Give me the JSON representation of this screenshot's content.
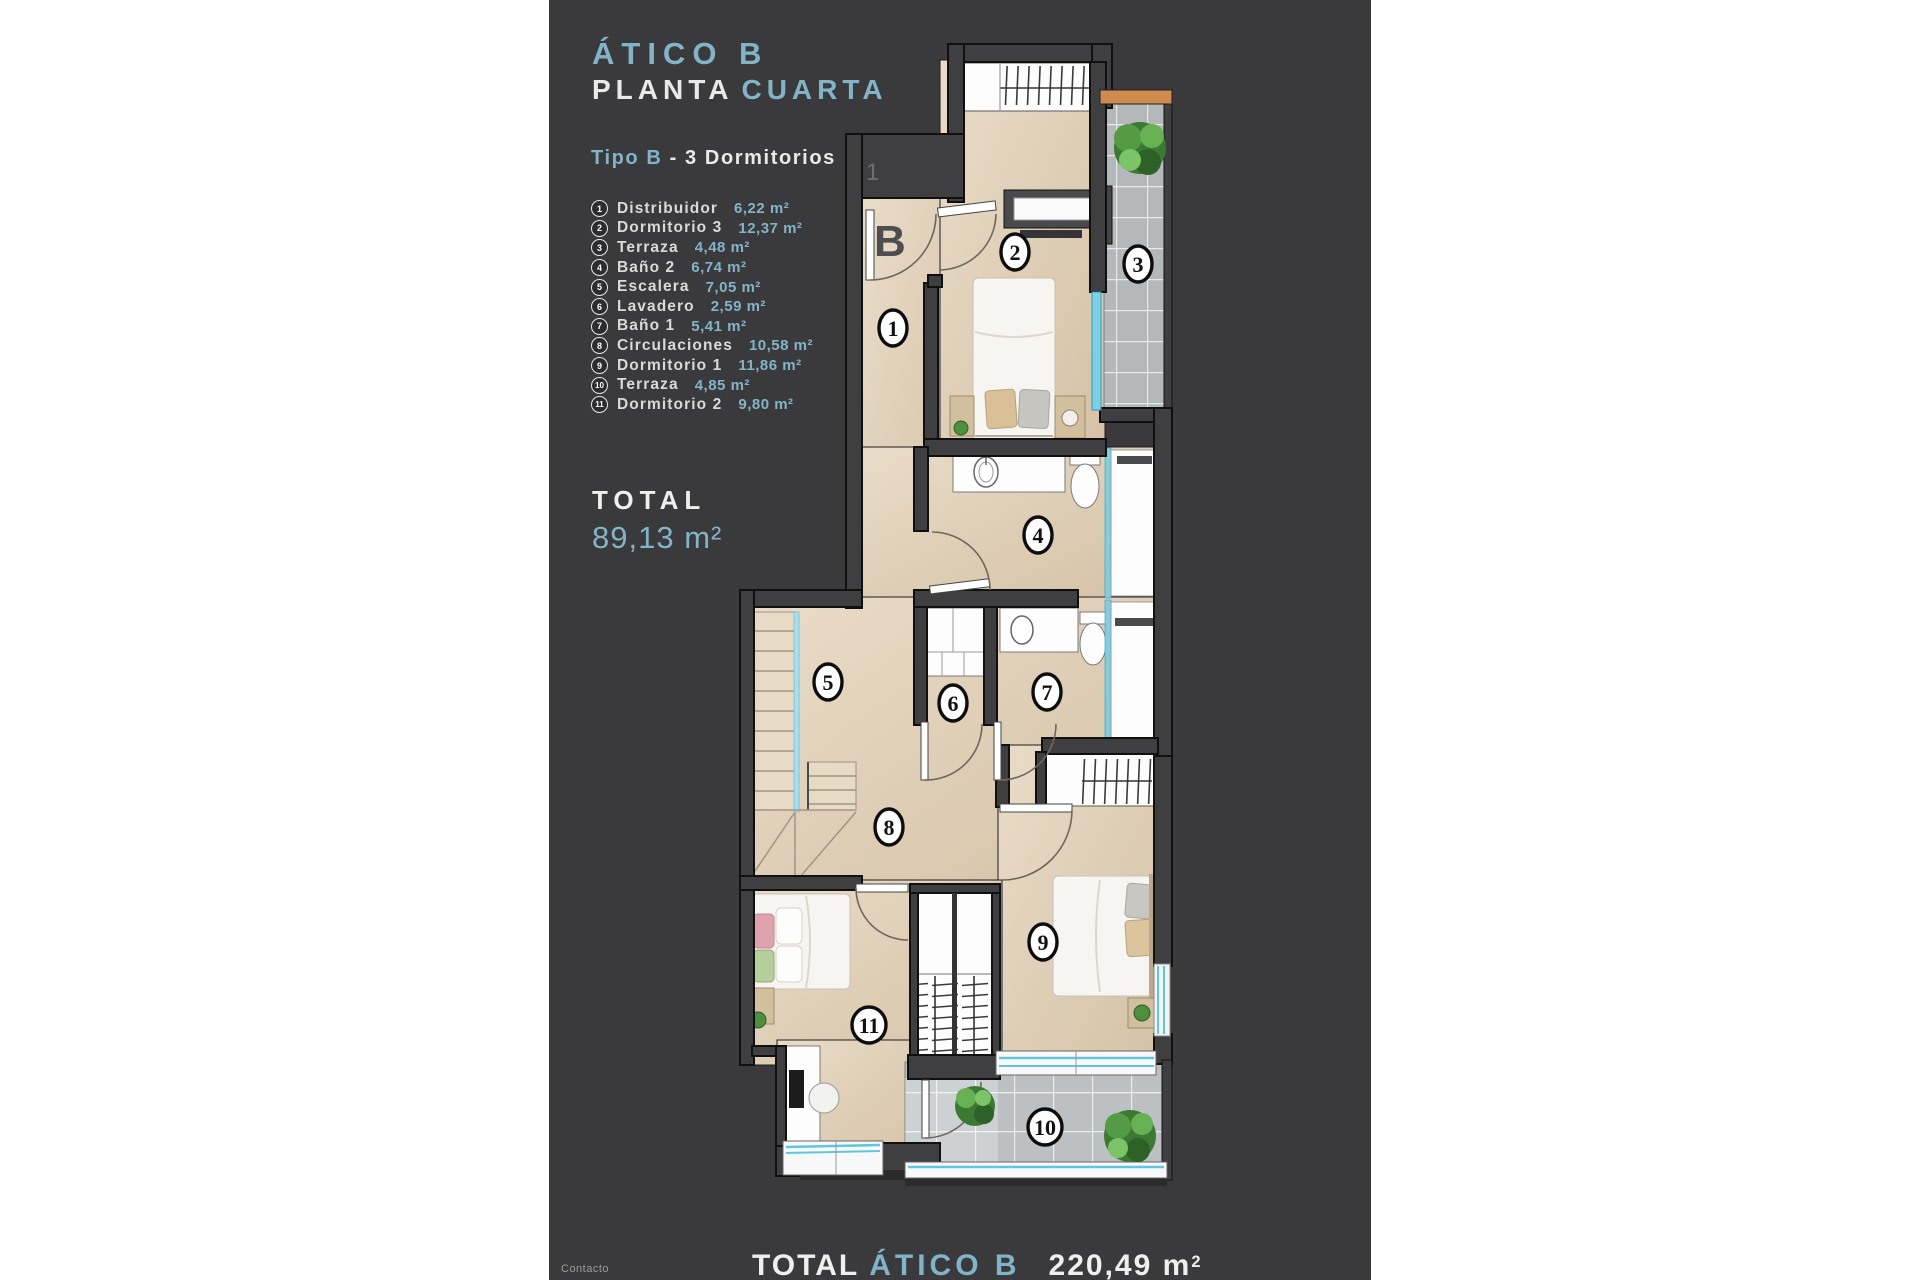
{
  "colors": {
    "accent": "#82b4c8",
    "panel_bg": "#3a3a3c",
    "page_bg": "#ffffff",
    "floor": "#e2d2ba",
    "wall": "#3f3f42",
    "tile": "#b6b9bb",
    "window_cyan": "#7ecfe4",
    "ledge_orange": "#cf8a4d"
  },
  "header": {
    "title": "ÁTICO B",
    "floor_white": "PLANTA",
    "floor_accent": "CUARTA",
    "type_accent": "Tipo B",
    "type_rest": "- 3 Dormitorios"
  },
  "legend": {
    "items": [
      {
        "num": "1",
        "label": "Distribuidor",
        "area": "6,22 m²"
      },
      {
        "num": "2",
        "label": "Dormitorio 3",
        "area": "12,37 m²"
      },
      {
        "num": "3",
        "label": "Terraza",
        "area": "4,48 m²"
      },
      {
        "num": "4",
        "label": "Baño 2",
        "area": "6,74 m²"
      },
      {
        "num": "5",
        "label": "Escalera",
        "area": "7,05 m²"
      },
      {
        "num": "6",
        "label": "Lavadero",
        "area": "2,59 m²"
      },
      {
        "num": "7",
        "label": "Baño 1",
        "area": "5,41 m²"
      },
      {
        "num": "8",
        "label": "Circulaciones",
        "area": "10,58 m²"
      },
      {
        "num": "9",
        "label": "Dormitorio 1",
        "area": "11,86 m²"
      },
      {
        "num": "10",
        "label": "Terraza",
        "area": "4,85 m²"
      },
      {
        "num": "11",
        "label": "Dormitorio 2",
        "area": "9,80 m²"
      }
    ]
  },
  "total": {
    "label": "TOTAL",
    "value": "89,13 m²"
  },
  "plan": {
    "entrance_label": "B",
    "faint_mark": "1",
    "rooms": [
      {
        "num": "1",
        "x": 893,
        "y": 328
      },
      {
        "num": "2",
        "x": 1015,
        "y": 252
      },
      {
        "num": "3",
        "x": 1138,
        "y": 264
      },
      {
        "num": "4",
        "x": 1038,
        "y": 535
      },
      {
        "num": "5",
        "x": 828,
        "y": 682
      },
      {
        "num": "6",
        "x": 953,
        "y": 703
      },
      {
        "num": "7",
        "x": 1047,
        "y": 692
      },
      {
        "num": "8",
        "x": 889,
        "y": 827
      },
      {
        "num": "9",
        "x": 1043,
        "y": 942
      },
      {
        "num": "10",
        "x": 1045,
        "y": 1127
      },
      {
        "num": "11",
        "x": 869,
        "y": 1025
      }
    ]
  },
  "footer": {
    "contact": "Contacto",
    "total_label": "TOTAL",
    "total_name": "ÁTICO B",
    "total_value": "220,49 m",
    "total_sup": "2"
  }
}
